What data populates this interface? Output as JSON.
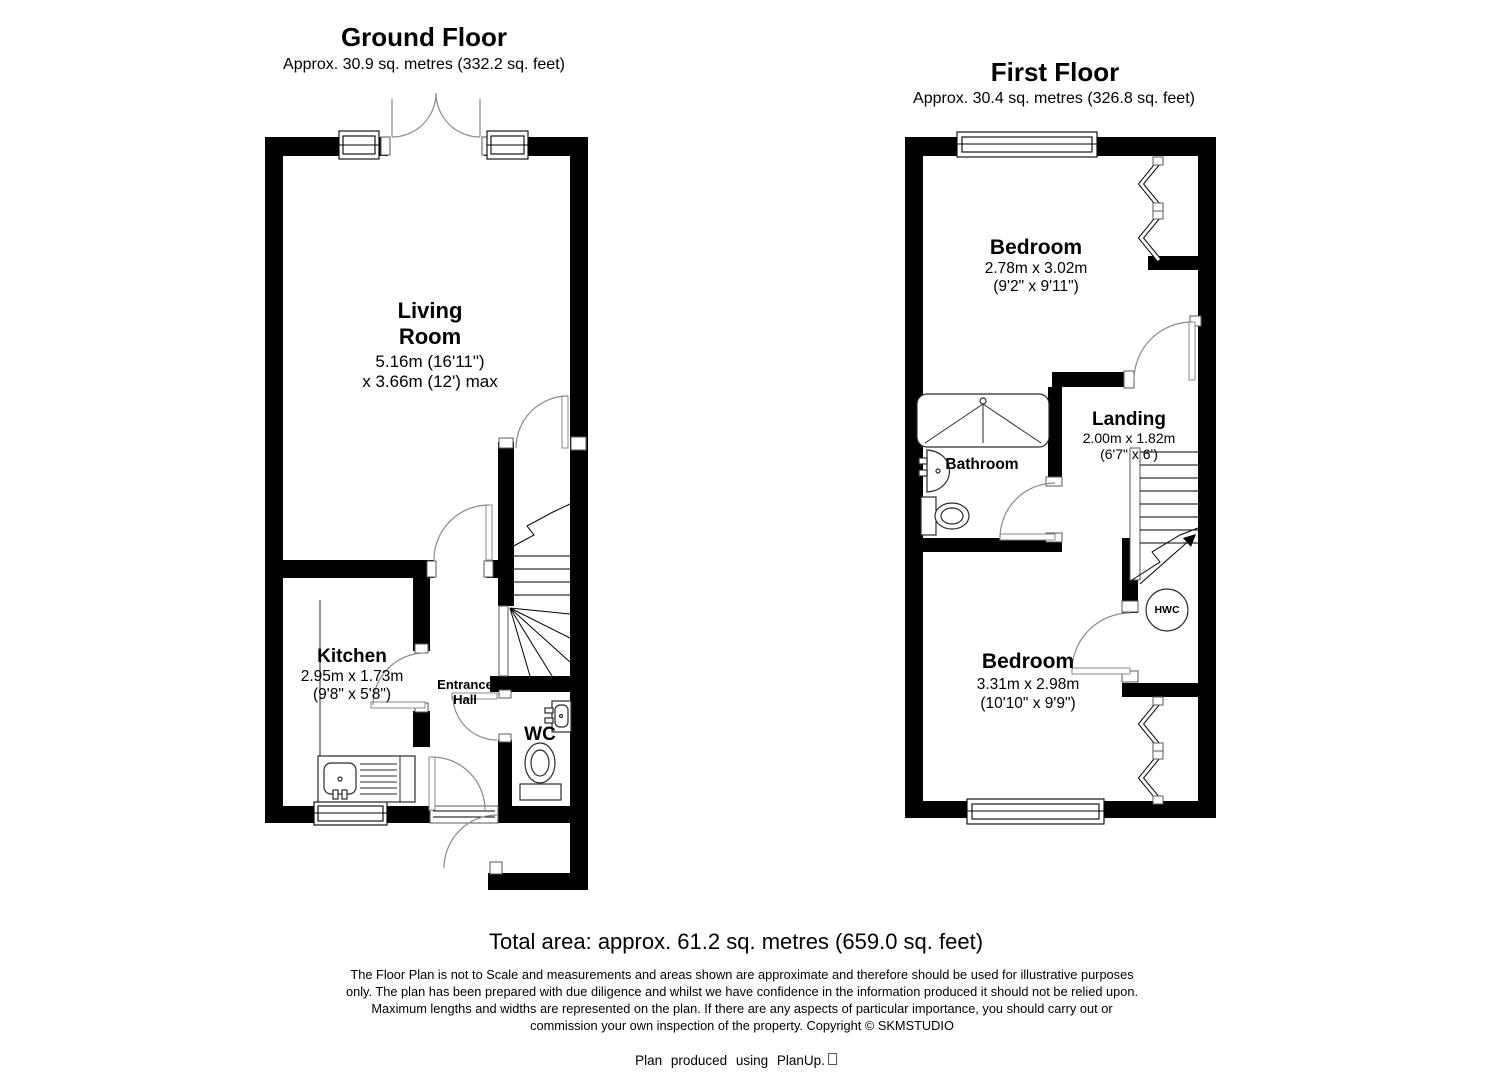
{
  "ground_floor": {
    "title": "Ground Floor",
    "subtitle": "Approx. 30.9 sq. metres (332.2 sq. feet)",
    "rooms": {
      "living_room": {
        "name_line1": "Living",
        "name_line2": "Room",
        "dim_line1": "5.16m (16'11\")",
        "dim_line2": "x 3.66m (12') max"
      },
      "kitchen": {
        "name": "Kitchen",
        "dim_line1": "2.95m x 1.73m",
        "dim_line2": "(9'8\" x 5'8\")"
      },
      "entrance_hall": {
        "name_line1": "Entrance",
        "name_line2": "Hall"
      },
      "wc": {
        "name": "WC"
      }
    }
  },
  "first_floor": {
    "title": "First Floor",
    "subtitle": "Approx. 30.4 sq. metres (326.8 sq. feet)",
    "rooms": {
      "bedroom_front": {
        "name": "Bedroom",
        "dim_line1": "2.78m x 3.02m",
        "dim_line2": "(9'2\" x 9'11\")"
      },
      "bathroom": {
        "name": "Bathroom"
      },
      "landing": {
        "name": "Landing",
        "dim_line1": "2.00m x 1.82m",
        "dim_line2": "(6'7\" x 6')"
      },
      "bedroom_back": {
        "name": "Bedroom",
        "dim_line1": "3.31m x 2.98m",
        "dim_line2": "(10'10\" x 9'9\")"
      },
      "hwc": {
        "label": "HWC"
      }
    }
  },
  "footer": {
    "total_area": "Total area: approx. 61.2 sq. metres (659.0 sq. feet)",
    "disclaimer_lines": [
      "The Floor Plan is not to Scale and measurements and areas shown are approximate and therefore should be used for illustrative purposes",
      "only. The plan has been prepared with due diligence and whilst we have confidence in the information produced it should not be relied upon.",
      "Maximum lengths and widths are represented on the plan. If there are any aspects of particular importance, you should carry out or",
      "commission your own inspection of the property. Copyright © SKMSTUDIO"
    ],
    "credit": "Plan produced using PlanUp."
  },
  "colors": {
    "wall": "#000000",
    "background": "#ffffff",
    "door_swing": "#8a8a8a"
  }
}
